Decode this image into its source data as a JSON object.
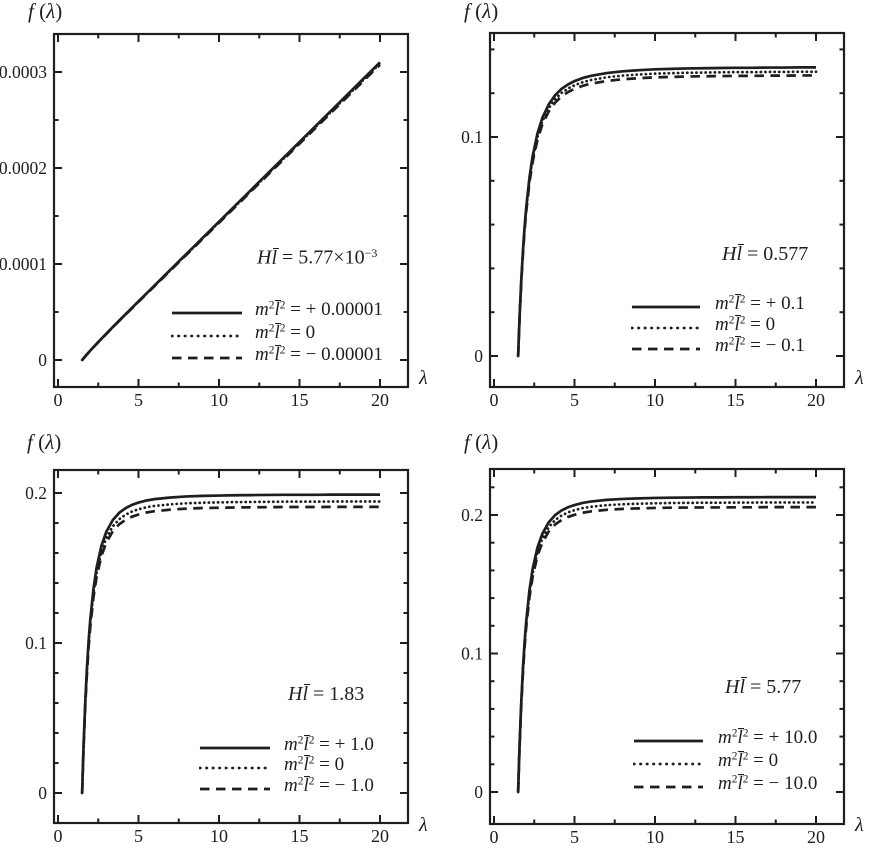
{
  "figure": {
    "background": "#ffffff",
    "ink": "#201d1c"
  },
  "axis_labels": {
    "y_text": "f(λ)",
    "x_text": "λ",
    "y_rich": [
      {
        "t": "f",
        "it": true
      },
      {
        "t": " ("
      },
      {
        "t": "λ",
        "it": true
      },
      {
        "t": ")"
      }
    ],
    "x_rich": [
      {
        "t": "λ",
        "it": true
      }
    ]
  },
  "chart_data": [
    {
      "type": "line",
      "panel": "top-left",
      "xlabel": "λ",
      "ylabel": "f(λ)",
      "annotation": "Hl̄ = 5.77×10⁻³",
      "annotation_rich": [
        {
          "t": "H",
          "it": true
        },
        {
          "t": "l",
          "it": true,
          "ov": true
        },
        {
          "t": " = 5.77×10"
        },
        {
          "t": "−3",
          "sup": true
        }
      ],
      "xlim": [
        -0.25,
        21.7
      ],
      "ylim": [
        -2.8e-05,
        0.000339
      ],
      "grid": false,
      "legend_position": "lower-right",
      "xticks": [
        0,
        5,
        10,
        15,
        20
      ],
      "xtick_labels": [
        "0",
        "5",
        "10",
        "15",
        "20"
      ],
      "xticks_minor": [
        2.5,
        7.5,
        12.5,
        17.5
      ],
      "yticks": [
        0,
        0.0001,
        0.0002,
        0.0003
      ],
      "ytick_labels": [
        "0",
        "0.0001",
        "0.0002",
        "0.0003"
      ],
      "yticks_minor": [
        5e-05,
        0.00015,
        0.00025
      ],
      "x": [
        1.5,
        1.6,
        1.7,
        1.8,
        2,
        2.2,
        2.5,
        3,
        3.5,
        4,
        5,
        6,
        7,
        8,
        10,
        12,
        14,
        16,
        18,
        19,
        20
      ],
      "f_base": [
        0,
        2e-06,
        4e-06,
        5.9e-06,
        9.7e-06,
        1.34e-05,
        1.87e-05,
        2.74e-05,
        3.6e-05,
        4.44e-05,
        6.11e-05,
        7.77e-05,
        9.43e-05,
        0.0001109,
        0.0001441,
        0.0001773,
        0.0002105,
        0.0002437,
        0.0002769,
        0.0002935,
        0.0003101
      ],
      "series": [
        {
          "label": "m²l̄² = + 0.00001",
          "style": "solid",
          "scale": 1,
          "label_rich": [
            {
              "t": "m",
              "it": true
            },
            {
              "t": "2",
              "sup": true
            },
            {
              "t": "l",
              "it": true,
              "ov": true
            },
            {
              "t": "2",
              "sup": true
            },
            {
              "t": " = + 0.00001"
            }
          ]
        },
        {
          "label": "m²l̄² = 0",
          "style": "dotted",
          "scale": 0.996,
          "label_rich": [
            {
              "t": "m",
              "it": true
            },
            {
              "t": "2",
              "sup": true
            },
            {
              "t": "l",
              "it": true,
              "ov": true
            },
            {
              "t": "2",
              "sup": true
            },
            {
              "t": " = 0"
            }
          ]
        },
        {
          "label": "m²l̄² = − 0.00001",
          "style": "dashed",
          "scale": 0.992,
          "label_rich": [
            {
              "t": "m",
              "it": true
            },
            {
              "t": "2",
              "sup": true
            },
            {
              "t": "l",
              "it": true,
              "ov": true
            },
            {
              "t": "2",
              "sup": true
            },
            {
              "t": " = − 0.00001"
            }
          ]
        }
      ]
    },
    {
      "type": "line",
      "panel": "top-right",
      "xlabel": "λ",
      "ylabel": "f(λ)",
      "annotation": "Hl̄ = 0.577",
      "annotation_rich": [
        {
          "t": "H",
          "it": true
        },
        {
          "t": "l",
          "it": true,
          "ov": true
        },
        {
          "t": " = 0.577"
        }
      ],
      "xlim": [
        -0.25,
        21.7
      ],
      "ylim": [
        -0.0142,
        0.147
      ],
      "grid": false,
      "legend_position": "lower-right",
      "xticks": [
        0,
        5,
        10,
        15,
        20
      ],
      "xtick_labels": [
        "0",
        "5",
        "10",
        "15",
        "20"
      ],
      "xticks_minor": [
        2.5,
        7.5,
        12.5,
        17.5
      ],
      "yticks": [
        0,
        0.1
      ],
      "ytick_labels": [
        "0",
        "0.1"
      ],
      "yticks_minor": [
        0.02,
        0.04,
        0.06,
        0.08,
        0.12,
        0.14
      ],
      "x": [
        1.5,
        1.55,
        1.6,
        1.7,
        1.8,
        1.9,
        2,
        2.2,
        2.4,
        2.7,
        3,
        3.4,
        3.8,
        4.2,
        4.6,
        5,
        5.5,
        6,
        7,
        8,
        9,
        10,
        11,
        12,
        13,
        14,
        15,
        16,
        17,
        18,
        19,
        20
      ],
      "f_base": [
        0,
        0.0104,
        0.0197,
        0.0355,
        0.0483,
        0.0589,
        0.0677,
        0.0813,
        0.0912,
        0.1016,
        0.1087,
        0.1149,
        0.1191,
        0.122,
        0.124,
        0.1255,
        0.1269,
        0.1279,
        0.1292,
        0.13,
        0.1305,
        0.1309,
        0.1311,
        0.1313,
        0.1314,
        0.1315,
        0.1316,
        0.1316,
        0.1317,
        0.1317,
        0.1318,
        0.1318
      ],
      "series": [
        {
          "label": "m²l̄² = + 0.1",
          "style": "solid",
          "scale": 1,
          "label_rich": [
            {
              "t": "m",
              "it": true
            },
            {
              "t": "2",
              "sup": true
            },
            {
              "t": "l",
              "it": true,
              "ov": true
            },
            {
              "t": "2",
              "sup": true
            },
            {
              "t": " = + 0.1"
            }
          ]
        },
        {
          "label": "m²l̄² = 0",
          "style": "dotted",
          "scale": 0.985,
          "label_rich": [
            {
              "t": "m",
              "it": true
            },
            {
              "t": "2",
              "sup": true
            },
            {
              "t": "l",
              "it": true,
              "ov": true
            },
            {
              "t": "2",
              "sup": true
            },
            {
              "t": " = 0"
            }
          ]
        },
        {
          "label": "m²l̄² = − 0.1",
          "style": "dashed",
          "scale": 0.972,
          "label_rich": [
            {
              "t": "m",
              "it": true
            },
            {
              "t": "2",
              "sup": true
            },
            {
              "t": "l",
              "it": true,
              "ov": true
            },
            {
              "t": "2",
              "sup": true
            },
            {
              "t": " = − 0.1"
            }
          ]
        }
      ]
    },
    {
      "type": "line",
      "panel": "bottom-left",
      "xlabel": "λ",
      "ylabel": "f(λ)",
      "annotation": "Hl̄ = 1.83",
      "annotation_rich": [
        {
          "t": "H",
          "it": true
        },
        {
          "t": "l",
          "it": true,
          "ov": true
        },
        {
          "t": " = 1.83"
        }
      ],
      "xlim": [
        -0.25,
        21.7
      ],
      "ylim": [
        -0.02,
        0.2167
      ],
      "grid": false,
      "legend_position": "lower-right",
      "xticks": [
        0,
        5,
        10,
        15,
        20
      ],
      "xtick_labels": [
        "0",
        "5",
        "10",
        "15",
        "20"
      ],
      "xticks_minor": [
        2.5,
        7.5,
        12.5,
        17.5
      ],
      "yticks": [
        0,
        0.1,
        0.2
      ],
      "ytick_labels": [
        "0",
        "0.1",
        "0.2"
      ],
      "yticks_minor": [
        0.02,
        0.04,
        0.06,
        0.08,
        0.12,
        0.14,
        0.16,
        0.18
      ],
      "x": [
        1.5,
        1.55,
        1.6,
        1.7,
        1.8,
        1.9,
        2,
        2.2,
        2.4,
        2.7,
        3,
        3.4,
        3.8,
        4.2,
        4.6,
        5,
        5.5,
        6,
        7,
        8,
        9,
        10,
        11,
        12,
        13,
        14,
        15,
        16,
        17,
        18,
        19,
        20
      ],
      "f_base": [
        0,
        0.0187,
        0.035,
        0.0623,
        0.0838,
        0.1011,
        0.115,
        0.1359,
        0.1504,
        0.1649,
        0.1741,
        0.1819,
        0.1868,
        0.1899,
        0.1921,
        0.1936,
        0.195,
        0.1959,
        0.197,
        0.1977,
        0.1981,
        0.1983,
        0.1985,
        0.1986,
        0.1987,
        0.1988,
        0.1988,
        0.1988,
        0.1989,
        0.1989,
        0.1989,
        0.1989
      ],
      "series": [
        {
          "label": "m²l̄² = + 1.0",
          "style": "solid",
          "scale": 1,
          "label_rich": [
            {
              "t": "m",
              "it": true
            },
            {
              "t": "2",
              "sup": true
            },
            {
              "t": "l",
              "it": true,
              "ov": true
            },
            {
              "t": "2",
              "sup": true
            },
            {
              "t": " = + 1.0"
            }
          ]
        },
        {
          "label": "m²l̄² = 0",
          "style": "dotted",
          "scale": 0.977,
          "label_rich": [
            {
              "t": "m",
              "it": true
            },
            {
              "t": "2",
              "sup": true
            },
            {
              "t": "l",
              "it": true,
              "ov": true
            },
            {
              "t": "2",
              "sup": true
            },
            {
              "t": " = 0"
            }
          ]
        },
        {
          "label": "m²l̄² = − 1.0",
          "style": "dashed",
          "scale": 0.959,
          "label_rich": [
            {
              "t": "m",
              "it": true
            },
            {
              "t": "2",
              "sup": true
            },
            {
              "t": "l",
              "it": true,
              "ov": true
            },
            {
              "t": "2",
              "sup": true
            },
            {
              "t": " = − 1.0"
            }
          ]
        }
      ]
    },
    {
      "type": "line",
      "panel": "bottom-right",
      "xlabel": "λ",
      "ylabel": "f(λ)",
      "annotation": "Hl̄ = 5.77",
      "annotation_rich": [
        {
          "t": "H",
          "it": true
        },
        {
          "t": "l",
          "it": true,
          "ov": true
        },
        {
          "t": " = 5.77"
        }
      ],
      "xlim": [
        -0.25,
        21.7
      ],
      "ylim": [
        -0.0231,
        0.2339
      ],
      "grid": false,
      "legend_position": "lower-right",
      "xticks": [
        0,
        5,
        10,
        15,
        20
      ],
      "xtick_labels": [
        "0",
        "5",
        "10",
        "15",
        "20"
      ],
      "xticks_minor": [
        2.5,
        7.5,
        12.5,
        17.5
      ],
      "yticks": [
        0,
        0.1,
        0.2
      ],
      "ytick_labels": [
        "0",
        "0.1",
        "0.2"
      ],
      "yticks_minor": [
        0.02,
        0.04,
        0.06,
        0.08,
        0.12,
        0.14,
        0.16,
        0.18,
        0.22
      ],
      "x": [
        1.5,
        1.55,
        1.6,
        1.7,
        1.8,
        1.9,
        2,
        2.2,
        2.4,
        2.7,
        3,
        3.4,
        3.8,
        4.2,
        4.6,
        5,
        5.5,
        6,
        7,
        8,
        9,
        10,
        11,
        12,
        13,
        14,
        15,
        16,
        17,
        18,
        19,
        20
      ],
      "f_base": [
        0,
        0.02,
        0.0375,
        0.0667,
        0.0897,
        0.1082,
        0.1231,
        0.1455,
        0.161,
        0.1765,
        0.1864,
        0.1947,
        0.2,
        0.2033,
        0.2056,
        0.2072,
        0.2087,
        0.2097,
        0.2109,
        0.2116,
        0.212,
        0.2123,
        0.2125,
        0.2126,
        0.2127,
        0.2127,
        0.2128,
        0.2128,
        0.2129,
        0.2129,
        0.2129,
        0.2129
      ],
      "series": [
        {
          "label": "m²l̄² = + 10.0",
          "style": "solid",
          "scale": 1,
          "label_rich": [
            {
              "t": "m",
              "it": true
            },
            {
              "t": "2",
              "sup": true
            },
            {
              "t": "l",
              "it": true,
              "ov": true
            },
            {
              "t": "2",
              "sup": true
            },
            {
              "t": " = + 10.0"
            }
          ]
        },
        {
          "label": "m²l̄² = 0",
          "style": "dotted",
          "scale": 0.982,
          "label_rich": [
            {
              "t": "m",
              "it": true
            },
            {
              "t": "2",
              "sup": true
            },
            {
              "t": "l",
              "it": true,
              "ov": true
            },
            {
              "t": "2",
              "sup": true
            },
            {
              "t": " = 0"
            }
          ]
        },
        {
          "label": "m²l̄² = − 10.0",
          "style": "dashed",
          "scale": 0.966,
          "label_rich": [
            {
              "t": "m",
              "it": true
            },
            {
              "t": "2",
              "sup": true
            },
            {
              "t": "l",
              "it": true,
              "ov": true
            },
            {
              "t": "2",
              "sup": true
            },
            {
              "t": " = − 10.0"
            }
          ]
        }
      ]
    }
  ]
}
